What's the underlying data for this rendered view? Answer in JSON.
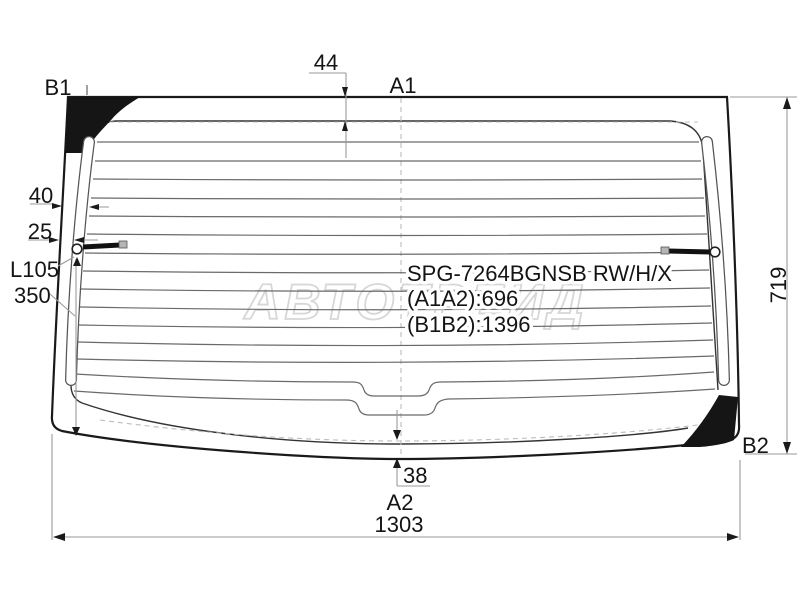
{
  "diagram": {
    "part_code": "SPG-7264BGNSB RW/H/X",
    "dims": {
      "a1a2": "(A1A2):696",
      "b1b2": "(B1B2):1396"
    },
    "points": {
      "a1": "A1",
      "a2": "A2",
      "b1": "B1",
      "b2": "B2"
    },
    "measurements": {
      "top_edge_offset": "44",
      "bottom_edge_offset": "38",
      "band_outer": "40",
      "band_inner": "25",
      "lead_length": "L105",
      "lead_drop": "350",
      "height": "719",
      "width": "1303"
    },
    "watermark": "АВТОТРЕЙД",
    "colors": {
      "outline": "#1a1a1a",
      "defroster_line": "#6a6a6a",
      "dimension_line": "#9a9a9a",
      "corner_fill": "#151515",
      "watermark": "#d7d7d7"
    }
  }
}
